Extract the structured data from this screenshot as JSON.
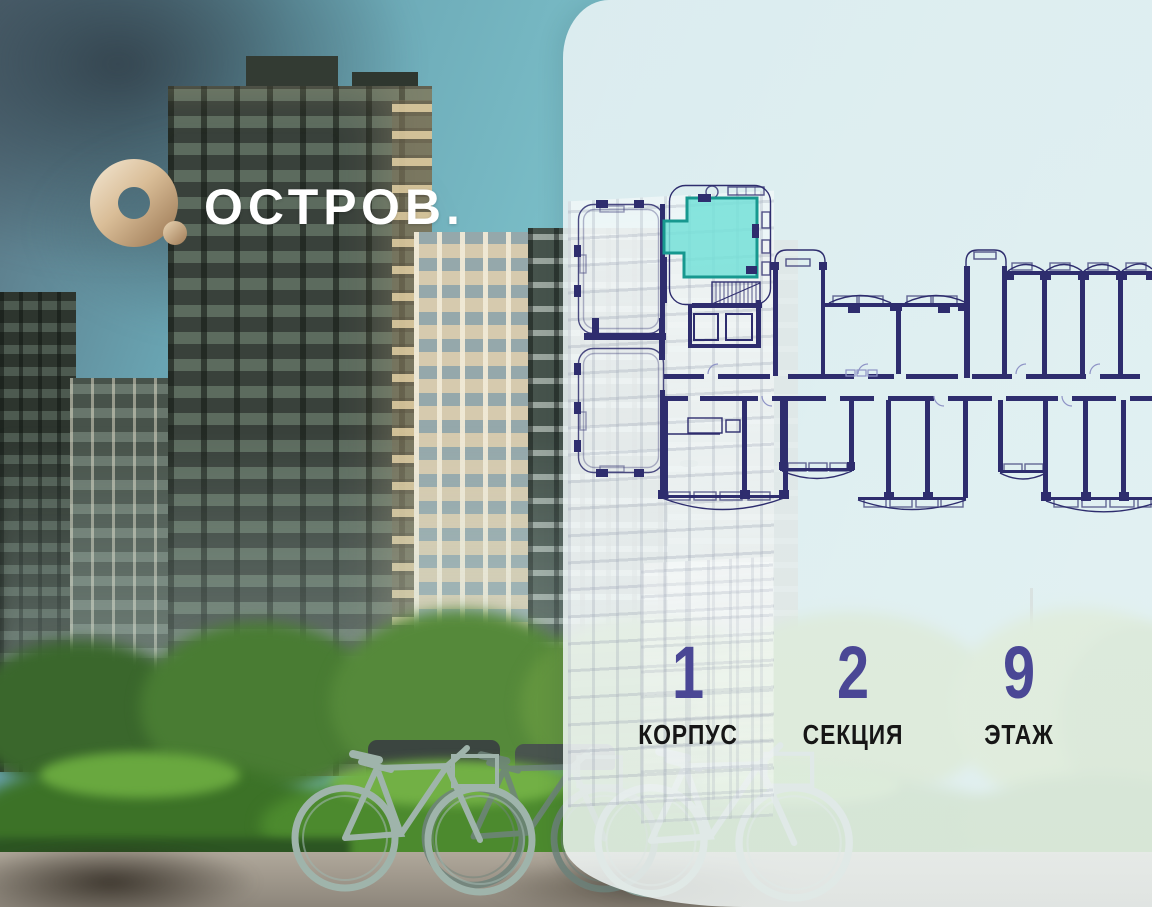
{
  "brand": {
    "wordmark": "ОСТРОВ.",
    "mark": "gold-ring-with-dot",
    "gold_color": "#c9a87f",
    "text_color": "#ffffff"
  },
  "floorplan": {
    "line_color": "#2e2d6e",
    "selected_unit": {
      "fill": "#74e0d8",
      "outline": "#17988f",
      "position": "top-left of section plan"
    }
  },
  "location": {
    "value_color": "#4a4795",
    "label_color": "#161616",
    "items": [
      {
        "value": "1",
        "label": "КОРПУС"
      },
      {
        "value": "2",
        "label": "СЕКЦИЯ"
      },
      {
        "value": "9",
        "label": "ЭТАЖ"
      }
    ]
  }
}
